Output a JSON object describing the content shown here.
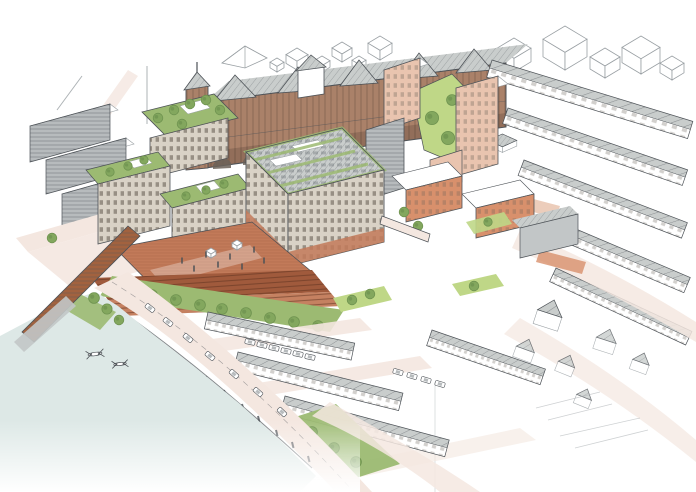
{
  "illustration": {
    "kind": "Hand-drawn aerial perspective masterplan sketch of a riverside urban development",
    "boat_count": 2,
    "regions": [
      "river",
      "railway-viaduct",
      "riverside-road",
      "riverside-park",
      "amphitheatre-steps",
      "brick-plaza",
      "central-office-building",
      "roof-garden-blocks",
      "victorian-warehouse",
      "massing-study-blocks",
      "courtyard-lawn",
      "salmon-towers",
      "terrace-rows",
      "street-grid",
      "sketch-fade-houses",
      "rowing-boats"
    ]
  },
  "palette": {
    "paper": "#ffffff",
    "ink": "#4d5257",
    "sketch": "#9aa0a4",
    "river": "#dde8e6",
    "road": "#f4e7e0",
    "plaza_brick": "#c27a59",
    "plaza_steps": "#a05a3c",
    "victorian_brick": "#aa8169",
    "victorian_dark": "#7d5f4c",
    "facade_beige": "#d9d2c6",
    "facade_gray": "#c2c6c7",
    "slab_gray": "#b7bbbd",
    "roof_gray": "#c9cdcc",
    "lawn_green": "#bfd787",
    "park_green": "#9cba72",
    "tree_green": "#83a75e",
    "tree_dark": "#6f9350",
    "salmon": "#e9c4af",
    "orange_brick": "#d8906c",
    "rust": "#a2623f",
    "window_dark": "#6b6258"
  }
}
